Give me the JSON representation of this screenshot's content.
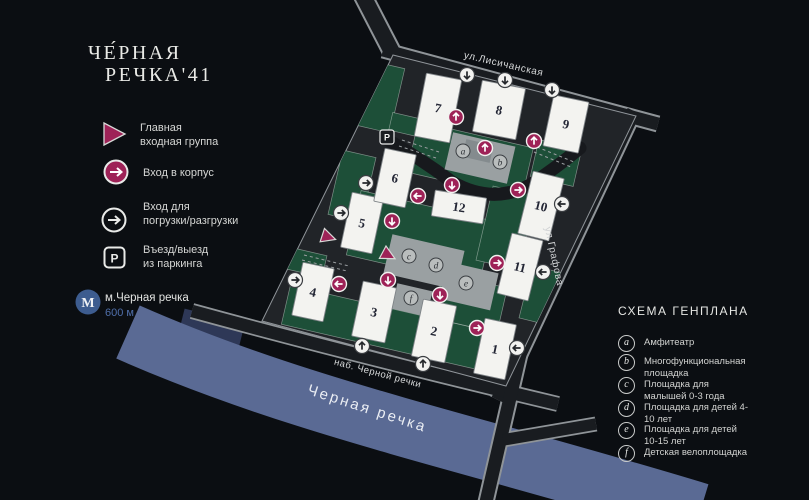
{
  "colors": {
    "accent": "#9e2257",
    "green": "#1d4f38",
    "plaza_gray": "#9aa0a2",
    "building": "#f3f3f0",
    "river": "#5a6a94",
    "metro_blue": "#3d5c8f",
    "road_dark": "#191c20",
    "road_edge": "#8f9498"
  },
  "brand": {
    "line1": "ЧЕ́РНАЯ",
    "line2": "РЕЧКА'41"
  },
  "legend_left": {
    "items": [
      {
        "icon": "main-entrance-triangle",
        "lines": [
          "Главная",
          "входная группа"
        ]
      },
      {
        "icon": "building-entrance-circle",
        "lines": [
          "Вход в корпус"
        ]
      },
      {
        "icon": "loading-entrance-circle",
        "lines": [
          "Вход для",
          "погрузки/разгрузки"
        ]
      },
      {
        "icon": "parking-badge",
        "badge": "P",
        "lines": [
          "Въезд/выезд",
          "из паркинга"
        ]
      }
    ],
    "metro": {
      "name": "м.Черная речка",
      "distance": "600 м"
    }
  },
  "legend_right": {
    "title": "СХЕМА ГЕНПЛАНА",
    "items": [
      {
        "letter": "a",
        "label": "Амфитеатр"
      },
      {
        "letter": "b",
        "label": "Многофункциональная площадка"
      },
      {
        "letter": "c",
        "label": "Площадка для малышей 0-3 года"
      },
      {
        "letter": "d",
        "label": "Площадка для детей 4-10 лет"
      },
      {
        "letter": "e",
        "label": "Площадка для детей 10-15 лет"
      },
      {
        "letter": "f",
        "label": "Детская велоплощадка"
      }
    ]
  },
  "map": {
    "labels": [
      {
        "name": "ул.Лисичанская",
        "x": 503,
        "y": 67,
        "rot": 13,
        "size": 10,
        "ls": 0.6,
        "color": "#d8dadb"
      },
      {
        "name": "ул.Графова",
        "x": 551,
        "y": 257,
        "rot": 78,
        "size": 10,
        "ls": 0.6,
        "color": "#cfd1d3"
      },
      {
        "name": "наб. Черной речки",
        "x": 377,
        "y": 376,
        "rot": 15,
        "size": 9.5,
        "ls": 0.5,
        "color": "#d8dadb"
      },
      {
        "name": "Черная речка",
        "x": 366,
        "y": 413,
        "rot": 18,
        "size": 15,
        "ls": 2.5,
        "color": "#eaedf3"
      }
    ],
    "buildings": [
      {
        "label": "1",
        "x": 495,
        "y": 349,
        "w": 32,
        "h": 56,
        "rot": 12
      },
      {
        "label": "2",
        "x": 434,
        "y": 331,
        "w": 34,
        "h": 58,
        "rot": 12
      },
      {
        "label": "3",
        "x": 374,
        "y": 312,
        "w": 34,
        "h": 56,
        "rot": 12
      },
      {
        "label": "4",
        "x": 313,
        "y": 292,
        "w": 32,
        "h": 54,
        "rot": 12
      },
      {
        "label": "5",
        "x": 362,
        "y": 223,
        "w": 32,
        "h": 56,
        "rot": 12
      },
      {
        "label": "6",
        "x": 395,
        "y": 178,
        "w": 32,
        "h": 54,
        "rot": 12
      },
      {
        "label": "7",
        "x": 438,
        "y": 108,
        "w": 36,
        "h": 64,
        "rot": 11
      },
      {
        "label": "8",
        "x": 499,
        "y": 110,
        "w": 44,
        "h": 52,
        "rot": 11
      },
      {
        "label": "9",
        "x": 566,
        "y": 124,
        "w": 36,
        "h": 52,
        "rot": 12
      },
      {
        "label": "10",
        "x": 541,
        "y": 206,
        "w": 32,
        "h": 64,
        "rot": 14
      },
      {
        "label": "11",
        "x": 520,
        "y": 267,
        "w": 32,
        "h": 62,
        "rot": 14
      },
      {
        "label": "12",
        "x": 459,
        "y": 207,
        "w": 52,
        "h": 26,
        "rot": 9
      }
    ],
    "markers": [
      {
        "letter": "a",
        "x": 463,
        "y": 151
      },
      {
        "letter": "b",
        "x": 500,
        "y": 162
      },
      {
        "letter": "c",
        "x": 409,
        "y": 256
      },
      {
        "letter": "d",
        "x": 436,
        "y": 265
      },
      {
        "letter": "e",
        "x": 466,
        "y": 283
      },
      {
        "letter": "f",
        "x": 411,
        "y": 298
      }
    ],
    "entrances": [
      {
        "x": 456,
        "y": 117,
        "dir": "up"
      },
      {
        "x": 485,
        "y": 148,
        "dir": "up"
      },
      {
        "x": 534,
        "y": 141,
        "dir": "up"
      },
      {
        "x": 452,
        "y": 185,
        "dir": "down"
      },
      {
        "x": 518,
        "y": 190,
        "dir": "right"
      },
      {
        "x": 418,
        "y": 196,
        "dir": "left"
      },
      {
        "x": 392,
        "y": 221,
        "dir": "down"
      },
      {
        "x": 339,
        "y": 284,
        "dir": "left"
      },
      {
        "x": 388,
        "y": 280,
        "dir": "down"
      },
      {
        "x": 440,
        "y": 295,
        "dir": "down"
      },
      {
        "x": 477,
        "y": 328,
        "dir": "right"
      },
      {
        "x": 497,
        "y": 263,
        "dir": "right"
      }
    ],
    "loading": [
      {
        "x": 467,
        "y": 75,
        "dir": "down"
      },
      {
        "x": 505,
        "y": 80,
        "dir": "down"
      },
      {
        "x": 552,
        "y": 90,
        "dir": "down"
      },
      {
        "x": 366,
        "y": 183,
        "dir": "right"
      },
      {
        "x": 341,
        "y": 213,
        "dir": "right"
      },
      {
        "x": 295,
        "y": 280,
        "dir": "right"
      },
      {
        "x": 562,
        "y": 204,
        "dir": "left"
      },
      {
        "x": 543,
        "y": 272,
        "dir": "left"
      },
      {
        "x": 517,
        "y": 348,
        "dir": "left"
      },
      {
        "x": 362,
        "y": 346,
        "dir": "up"
      },
      {
        "x": 423,
        "y": 364,
        "dir": "up"
      }
    ],
    "triangles": [
      {
        "x": 328,
        "y": 237,
        "rot": 18
      },
      {
        "x": 388,
        "y": 255,
        "rot": 28
      }
    ],
    "parking_badges": [
      {
        "x": 387,
        "y": 137,
        "label": "P"
      }
    ]
  }
}
